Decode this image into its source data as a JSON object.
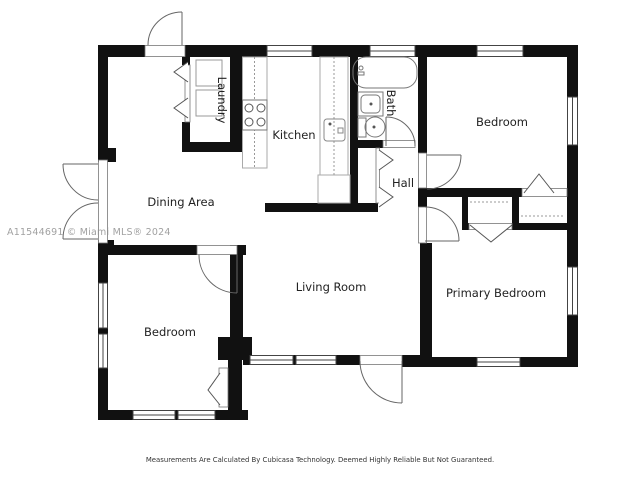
{
  "watermark": "A11544691 © Miami MLS® 2024",
  "disclaimer": "Measurements Are Calculated By Cubicasa Technology. Deemed Highly Reliable But Not Guaranteed.",
  "rooms": {
    "laundry": {
      "label": "Laundry"
    },
    "kitchen": {
      "label": "Kitchen"
    },
    "bath": {
      "label": "Bath"
    },
    "hall": {
      "label": "Hall"
    },
    "bedroom_top_right": {
      "label": "Bedroom"
    },
    "dining_area": {
      "label": "Dining Area"
    },
    "living_room": {
      "label": "Living Room"
    },
    "primary_bedroom": {
      "label": "Primary Bedroom"
    },
    "bedroom_bottom_left": {
      "label": "Bedroom"
    }
  },
  "fixtures": [
    "washer",
    "dryer",
    "stove",
    "kitchen-sink",
    "bathtub",
    "bathroom-sink",
    "toilet"
  ],
  "colors": {
    "wall": "#111111",
    "fixture_outline": "#888888",
    "window_frame": "#444444",
    "door_line": "#666666",
    "label_text": "#222222",
    "watermark_text": "#919191",
    "disclaimer_text": "#333333",
    "background": "#ffffff"
  }
}
